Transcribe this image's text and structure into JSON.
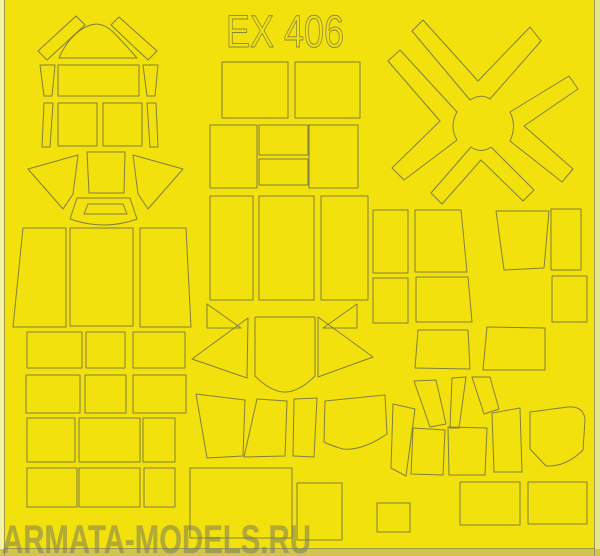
{
  "sheet": {
    "product_code": "EX 406",
    "watermark": "ARMATA-MODELS.RU",
    "colors": {
      "tape_yellow": "#f2e10c",
      "cut_line": "#6f6f45",
      "edge_left": "#f6f2a3",
      "edge_right": "#ebe388",
      "edge_bottom": "#d2c54e",
      "watermark_gray": "#6e6e60"
    },
    "mask_shapes": [
      {
        "name": "mask-band-slanted-left",
        "path": "M38,51 L76,16 L85,25 L47,60 Z"
      },
      {
        "name": "mask-dome",
        "path": "M59,58 C65,44 75,31 88,26 C97,22 106,25 114,33 C122,41 130,50 137,58 Z"
      },
      {
        "name": "mask-band-slanted-right",
        "path": "M119,17 L157,51 L148,60 L111,25 Z"
      },
      {
        "name": "mask-strip",
        "path": "M40,65 L55,65 L52,96 L44,96 Z"
      },
      {
        "name": "mask-wide-rect",
        "path": "M58,65 L139,65 L139,96 L58,96 Z"
      },
      {
        "name": "mask-strip",
        "path": "M143,65 L158,65 L155,96 L147,96 Z"
      },
      {
        "name": "mask-strip",
        "path": "M44,103 L53,103 L50,147 L42,147 Z"
      },
      {
        "name": "mask-square",
        "path": "M58,103 L97,103 L97,146 L58,146 Z"
      },
      {
        "name": "mask-square",
        "path": "M103,103 L142,103 L142,146 L103,146 Z"
      },
      {
        "name": "mask-strip",
        "path": "M147,103 L156,103 L158,147 L150,147 Z"
      },
      {
        "name": "mask-wing-left",
        "path": "M28,169 L78,155 L73,194 L63,209 Z"
      },
      {
        "name": "mask-square",
        "path": "M87,152 L125,152 L124,193 L89,193 Z"
      },
      {
        "name": "mask-wing-right",
        "path": "M183,169 L133,155 L138,194 L148,209 Z"
      },
      {
        "name": "mask-windscreen-frame-outer",
        "path": "M77,198 L130,198 L137,219 Q104,231 70,219 Z"
      },
      {
        "name": "mask-windscreen-frame-inner",
        "path": "M88,204 L123,204 L127,214 L84,214 Z"
      },
      {
        "name": "mask-tall-panel",
        "path": "M23,228 L66,228 L66,327 L13,327 Z"
      },
      {
        "name": "mask-tall-panel",
        "path": "M70,228 L133,228 L133,326 L70,326 Z"
      },
      {
        "name": "mask-tall-panel",
        "path": "M140,228 L186,228 L191,327 L140,327 Z"
      },
      {
        "name": "mask-rect",
        "path": "M27,332 L82,332 L82,368 L27,368 Z"
      },
      {
        "name": "mask-rect",
        "path": "M86,332 L125,332 L125,368 L86,368 Z"
      },
      {
        "name": "mask-rect",
        "path": "M133,332 L185,332 L185,368 L133,368 Z"
      },
      {
        "name": "mask-rect",
        "path": "M26,375 L80,375 L80,413 L26,413 Z"
      },
      {
        "name": "mask-rect",
        "path": "M85,375 L126,375 L126,413 L85,413 Z"
      },
      {
        "name": "mask-rect",
        "path": "M133,375 L186,375 L186,413 L133,413 Z"
      },
      {
        "name": "mask-rect",
        "path": "M27,418 L75,418 L75,462 L27,462 Z"
      },
      {
        "name": "mask-rect",
        "path": "M79,418 L140,418 L140,462 L79,462 Z"
      },
      {
        "name": "mask-rect-narrow",
        "path": "M143,418 L175,418 L175,462 L143,462 Z"
      },
      {
        "name": "mask-rect",
        "path": "M27,468 L77,468 L77,507 L27,507 Z"
      },
      {
        "name": "mask-rect",
        "path": "M79,468 L140,468 L140,507 L79,507 Z"
      },
      {
        "name": "mask-rect-narrow",
        "path": "M144,468 L175,468 L175,507 L144,507 Z"
      },
      {
        "name": "mask-rect",
        "path": "M222,62 L288,62 L288,118 L222,118 Z"
      },
      {
        "name": "mask-rect",
        "path": "M295,62 L360,62 L360,118 L295,118 Z"
      },
      {
        "name": "mask-rect",
        "path": "M210,125 L257,125 L257,188 L210,188 Z"
      },
      {
        "name": "mask-rect-small",
        "path": "M259,125 L308,125 L308,155 L259,155 Z"
      },
      {
        "name": "mask-rect-small",
        "path": "M259,159 L308,159 L308,185 L259,185 Z"
      },
      {
        "name": "mask-rect",
        "path": "M309,125 L358,125 L358,188 L309,188 Z"
      },
      {
        "name": "mask-tall-panel",
        "path": "M210,196 L253,196 L253,300 L210,300 Z"
      },
      {
        "name": "mask-tall-panel",
        "path": "M259,196 L314,196 L314,300 L259,300 Z"
      },
      {
        "name": "mask-tall-panel",
        "path": "M321,196 L368,196 L368,300 L321,300 Z"
      },
      {
        "name": "mask-triangle-small-left",
        "path": "M207,304 L241,328 L207,328 Z"
      },
      {
        "name": "mask-triangle-small-right",
        "path": "M357,304 L357,328 L323,328 Z"
      },
      {
        "name": "mask-triangle-big-left",
        "path": "M192,359 L248,318 L247,378 Z"
      },
      {
        "name": "mask-canopy-center",
        "path": "M255,318 Q255,317 256,317 L314,317 Q315,317 315,318 L315,376 Q299,392 285,392 Q271,392 255,376 Z"
      },
      {
        "name": "mask-triangle-big-right",
        "path": "M373,357 L318,317 L318,377 Z"
      },
      {
        "name": "mask-quad-panel",
        "path": "M196,394 L245,400 L243,456 L207,458 Z"
      },
      {
        "name": "mask-quad-panel",
        "path": "M257,399 L287,401 L285,456 L244,457 Z"
      },
      {
        "name": "mask-quad-panel",
        "path": "M294,399 L317,398 L314,457 L293,456 Z"
      },
      {
        "name": "mask-quad-panel",
        "path": "M325,401 L385,395 L387,434 Q362,451 343,449 Q332,446 324,442 Z"
      },
      {
        "name": "mask-rect",
        "path": "M373,210 L408,210 L408,273 L373,273 Z"
      },
      {
        "name": "mask-trapezoid",
        "path": "M415,210 L461,210 L467,272 L415,272 Z"
      },
      {
        "name": "mask-rect",
        "path": "M373,278 L408,278 L408,323 L373,323 Z"
      },
      {
        "name": "mask-trapezoid",
        "path": "M416,277 L468,277 L472,322 L416,322 Z"
      },
      {
        "name": "mask-trapezoid",
        "path": "M418,330 L468,330 L470,369 L415,368 Z"
      },
      {
        "name": "mask-trapezoid",
        "path": "M487,327 L545,328 L545,370 L483,370 Z"
      },
      {
        "name": "mask-trapezoid",
        "path": "M496,211 L549,211 L544,268 L504,270 Z"
      },
      {
        "name": "mask-rect",
        "path": "M551,209 L581,209 L581,270 L551,270 Z"
      },
      {
        "name": "mask-rect",
        "path": "M552,276 L587,276 L587,322 L552,322 Z"
      },
      {
        "name": "mask-fan-blade",
        "path": "M393,404 L415,409 L406,476 L391,468 Z"
      },
      {
        "name": "mask-fan-blade",
        "path": "M413,428 L445,430 L443,475 L411,474 Z"
      },
      {
        "name": "mask-fan-blade",
        "path": "M448,427 L487,428 L485,475 L449,475 Z"
      },
      {
        "name": "mask-fan-blade",
        "path": "M492,413 L520,408 L522,472 L494,472 Z"
      },
      {
        "name": "mask-fan-sliver",
        "path": "M414,381 L436,380 L446,424 L430,427 Z"
      },
      {
        "name": "mask-fan-sliver",
        "path": "M452,378 L466,377 L459,428 L450,428 Z"
      },
      {
        "name": "mask-fan-sliver",
        "path": "M472,377 L490,377 L499,409 L484,414 Z"
      },
      {
        "name": "mask-rounded-quad",
        "path": "M530,412 L568,407 Q584,406 585,420 L583,450 Q566,467 546,466 L530,449 Z"
      },
      {
        "name": "mask-big-rect",
        "path": "M190,468 L292,468 L292,538 L190,538 Z"
      },
      {
        "name": "mask-rect",
        "path": "M297,483 L342,483 L342,540 L297,540 Z"
      },
      {
        "name": "mask-rect-small",
        "path": "M377,503 L410,503 L410,532 L377,532 Z"
      },
      {
        "name": "mask-rect",
        "path": "M460,482 L520,482 L520,525 L460,525 Z"
      },
      {
        "name": "mask-rect",
        "path": "M528,482 L587,482 L587,524 L528,524 Z"
      },
      {
        "name": "mask-spinner-blade-top",
        "path": "M412,31 L470,100 Q481,93 490,99 L541,41 L530,27 L478,81 L423,20 Z"
      },
      {
        "name": "mask-spinner-blade-left",
        "path": "M400,50 L457,112 Q449,126 457,140 L404,180 L392,168 L440,121 L388,61 Z"
      },
      {
        "name": "mask-spinner-blade-right",
        "path": "M569,76 L510,112 Q517,126 510,141 L562,182 L573,169 L524,126 L578,89 Z"
      },
      {
        "name": "mask-spinner-blade-bottom",
        "path": "M431,193 L471,147 Q481,154 491,147 L534,190 L523,201 L481,160 L442,204 Z"
      }
    ]
  }
}
